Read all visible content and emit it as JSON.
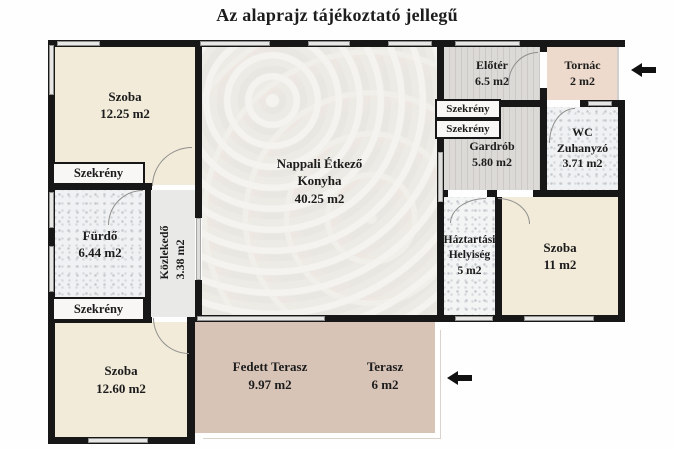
{
  "title": "Az alaprajz tájékoztató jellegű",
  "closet_label": "Szekrény",
  "rooms": {
    "szoba_top_left": {
      "name": "Szoba",
      "area": "12.25 m2"
    },
    "furdo": {
      "name": "Fürdő",
      "area": "6.44 m2"
    },
    "kozlekedo": {
      "name": "Közlekedő",
      "area": "3.38 m2"
    },
    "szoba_bottom_left": {
      "name": "Szoba",
      "area": "12.60 m2"
    },
    "nappali": {
      "line1": "Nappali Étkező",
      "line2": "Konyha",
      "area": "40.25 m2"
    },
    "eloter": {
      "name": "Előtér",
      "area": "6.5 m2"
    },
    "tornac": {
      "name": "Tornác",
      "area": "2 m2"
    },
    "gardrob": {
      "name": "Gardrób",
      "area": "5.80 m2"
    },
    "wc": {
      "line1": "WC",
      "line2": "Zuhanyzó",
      "area": "3.71 m2"
    },
    "haztartasi": {
      "line1": "Háztartási",
      "line2": "Helyiség",
      "area": "5 m2"
    },
    "szoba_right": {
      "name": "Szoba",
      "area": "11 m2"
    },
    "fedett_terasz": {
      "name": "Fedett Terasz",
      "area": "9.97 m2"
    },
    "terasz": {
      "name": "Terasz",
      "area": "6 m2"
    }
  },
  "colors": {
    "wall": "#171717",
    "room_beige": "#f2ebd9",
    "terrace": "#d8c4b7",
    "tornac": "#eddacd",
    "plank": "#d6d3d0",
    "tile": "#f0f1f2",
    "marble": "#e9e7e2"
  }
}
